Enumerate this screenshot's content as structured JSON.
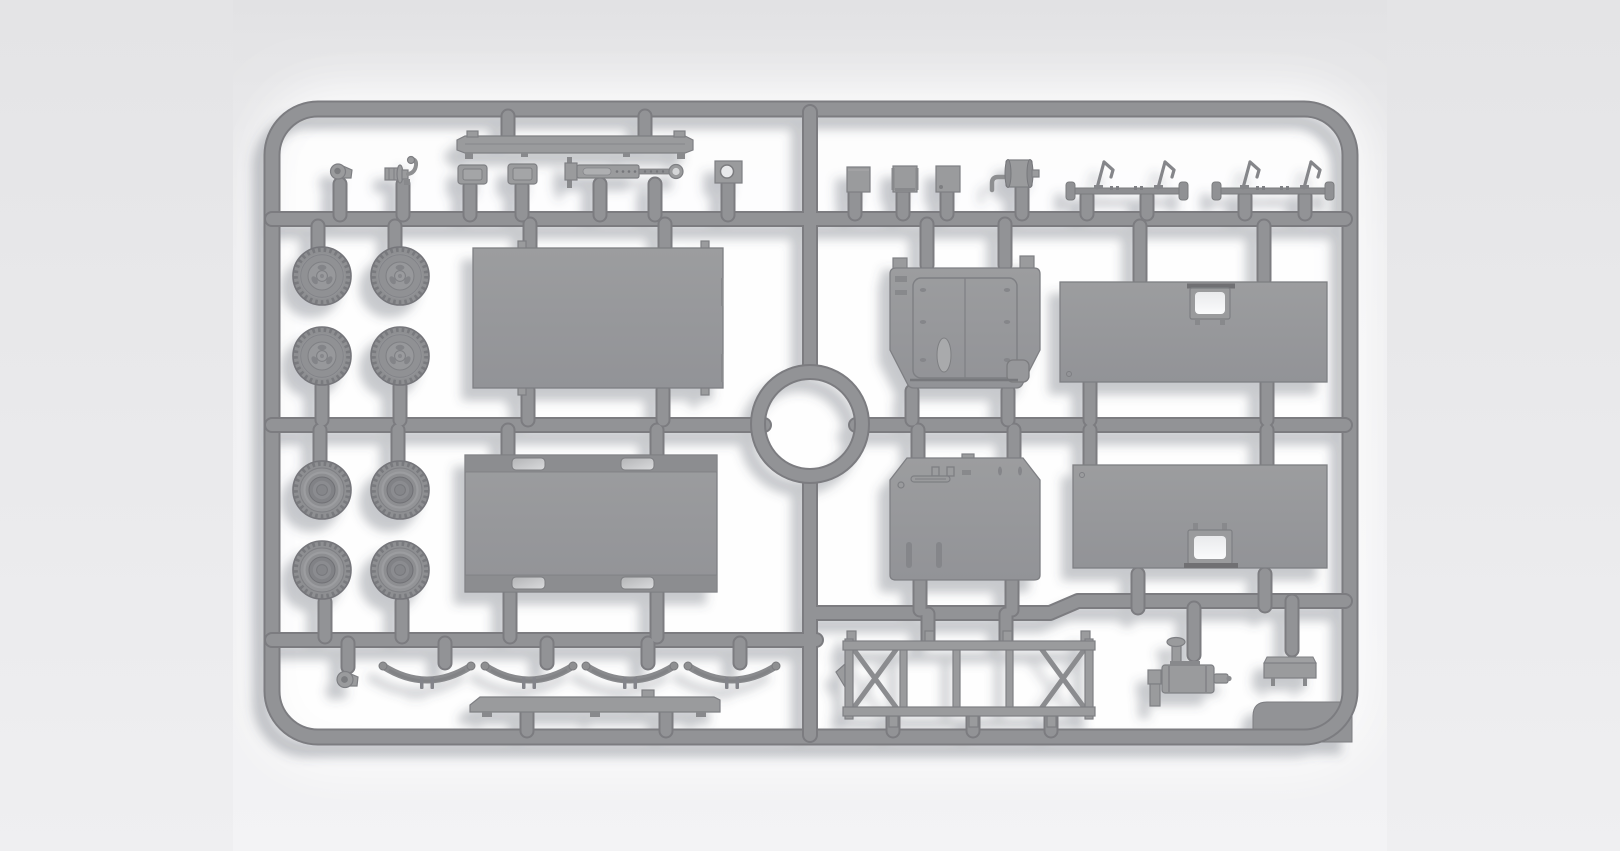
{
  "scene": {
    "type": "product-photo",
    "subject": "Unassembled gray injection-molded plastic model kit sprue with military truck parts on a white studio backdrop",
    "orientation": "landscape",
    "colors": {
      "page_top": "#e4e4e6",
      "page_bot": "#efeff1",
      "photo_top": "#e2e2e4",
      "photo_bot": "#f3f3f5",
      "glow": "#ffffff",
      "plastic": "#929396",
      "plastic2": "#9a9b9d",
      "pdark": "#88898c",
      "edge": "#7b7c80",
      "pedge": "#7e7f83",
      "recess_hi": "#d9dadc",
      "window_cutout": "#f6f7f9",
      "shadow": "#4b4e58"
    },
    "lighting": "soft light from upper right, shadows cast to lower left"
  },
  "sprue": {
    "frame_shape": "rounded rectangle with circular ring hub at center",
    "runners": [
      "top horizontal",
      "middle horizontal through center ring",
      "bottom horizontal (stepped on right)",
      "central vertical divider"
    ],
    "parts_inventory": [
      {
        "name": "road-wheel-outer-face",
        "count": 4,
        "area": "upper-left"
      },
      {
        "name": "road-wheel-inner-face",
        "count": 4,
        "area": "lower-left"
      },
      {
        "name": "flat-roof-panel",
        "count": 1,
        "area": "upper-left"
      },
      {
        "name": "floor-panel-with-hatches",
        "count": 1,
        "area": "lower-left"
      },
      {
        "name": "cab-hood-panel",
        "count": 1,
        "area": "upper-center-right"
      },
      {
        "name": "cab-back-panel",
        "count": 1,
        "area": "lower-center-right"
      },
      {
        "name": "body-side-panel-with-window",
        "count": 2,
        "area": "right"
      },
      {
        "name": "bumper-bar",
        "count": 2,
        "area": "top-left and bottom-left rows"
      },
      {
        "name": "leaf-spring",
        "count": 4,
        "area": "bottom-left row"
      },
      {
        "name": "axle-with-levers",
        "count": 2,
        "area": "top-right row"
      },
      {
        "name": "stowage-box",
        "count": 3,
        "area": "top-right row"
      },
      {
        "name": "hatch-plate",
        "count": 2,
        "area": "top-left row"
      },
      {
        "name": "winch-drum",
        "count": 1,
        "area": "top-right row"
      },
      {
        "name": "towing-hook",
        "count": 1,
        "area": "top-left row"
      },
      {
        "name": "shackle-eyelet",
        "count": 2,
        "area": "top-left and bottom-left rows"
      },
      {
        "name": "steering-damper-cylinder",
        "count": 1,
        "area": "top-left row"
      },
      {
        "name": "bracket-plate-with-hole",
        "count": 1,
        "area": "top-left row"
      },
      {
        "name": "ladder-chassis-frame",
        "count": 1,
        "area": "bottom-right"
      },
      {
        "name": "compressor-muffler",
        "count": 1,
        "area": "bottom-right"
      },
      {
        "name": "seat-bench",
        "count": 1,
        "area": "bottom-right"
      },
      {
        "name": "blank-molding-tab",
        "count": 1,
        "area": "bottom-right corner"
      }
    ]
  }
}
